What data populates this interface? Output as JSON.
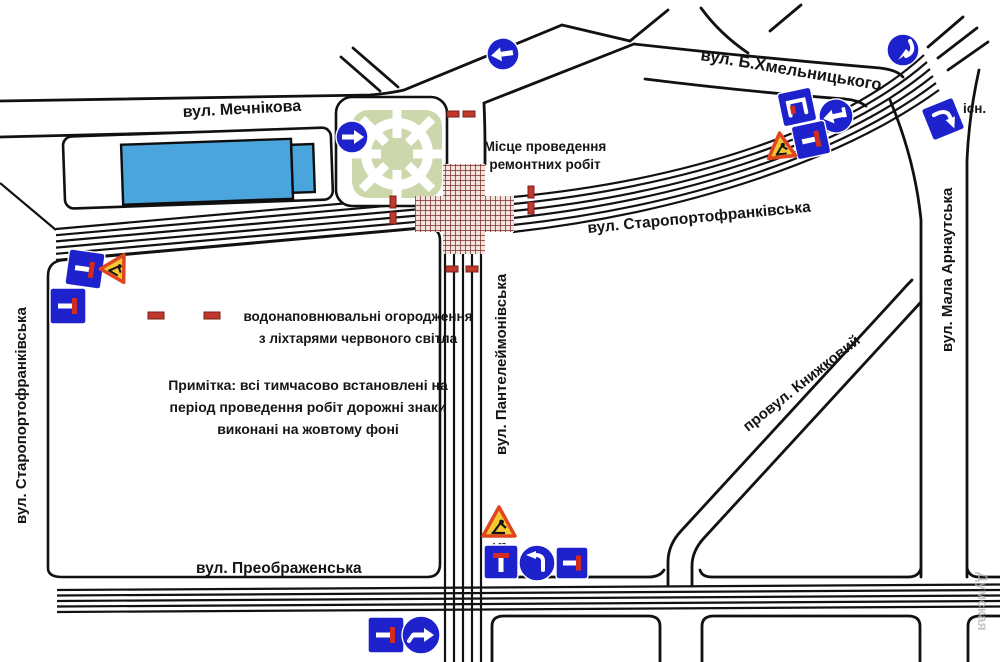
{
  "streets": {
    "mechnikova": "вул. Мечнікова",
    "khmelnytskoho": "вул. Б.Хмельницького",
    "staroportofrankivska": "вул. Старопортофранківська",
    "staroportofrankivska_west": "вул. Старопортофранківська",
    "panteleimonivska": "вул. Пантелеймонівська",
    "mala_arnautska": "вул. Мала Арнаутська",
    "knyzhkovyi": "провул. Книжковий",
    "preobrazhenska": "вул. Преображенська"
  },
  "repair_site": {
    "line1": "Місце проведення",
    "line2": "ремонтних робіт"
  },
  "legend": {
    "barrier_line1": "водонаповнювальні огородження",
    "barrier_line2": "з ліхтарями червоного світла",
    "note_line1": "Примітка: всі тимчасово встановлені на",
    "note_line2": "період проведення робіт дорожні знаки",
    "note_line3": "виконані на жовтому фоні"
  },
  "labels": {
    "existing": "існ.",
    "watermark": "Думская",
    "roadworks_code": "1.37"
  },
  "colors": {
    "road": "#111111",
    "sign_blue": "#1e22cc",
    "sign_red": "#d22c20",
    "barrier_red": "#c0392b",
    "warning_yellow": "#f5c832",
    "warning_border": "#e0451f",
    "building_blue": "#4aa5dc",
    "park_green": "#ccd7ab",
    "hatch_red": "#7d2d28",
    "watermark_gray": "#b5b5b5"
  }
}
